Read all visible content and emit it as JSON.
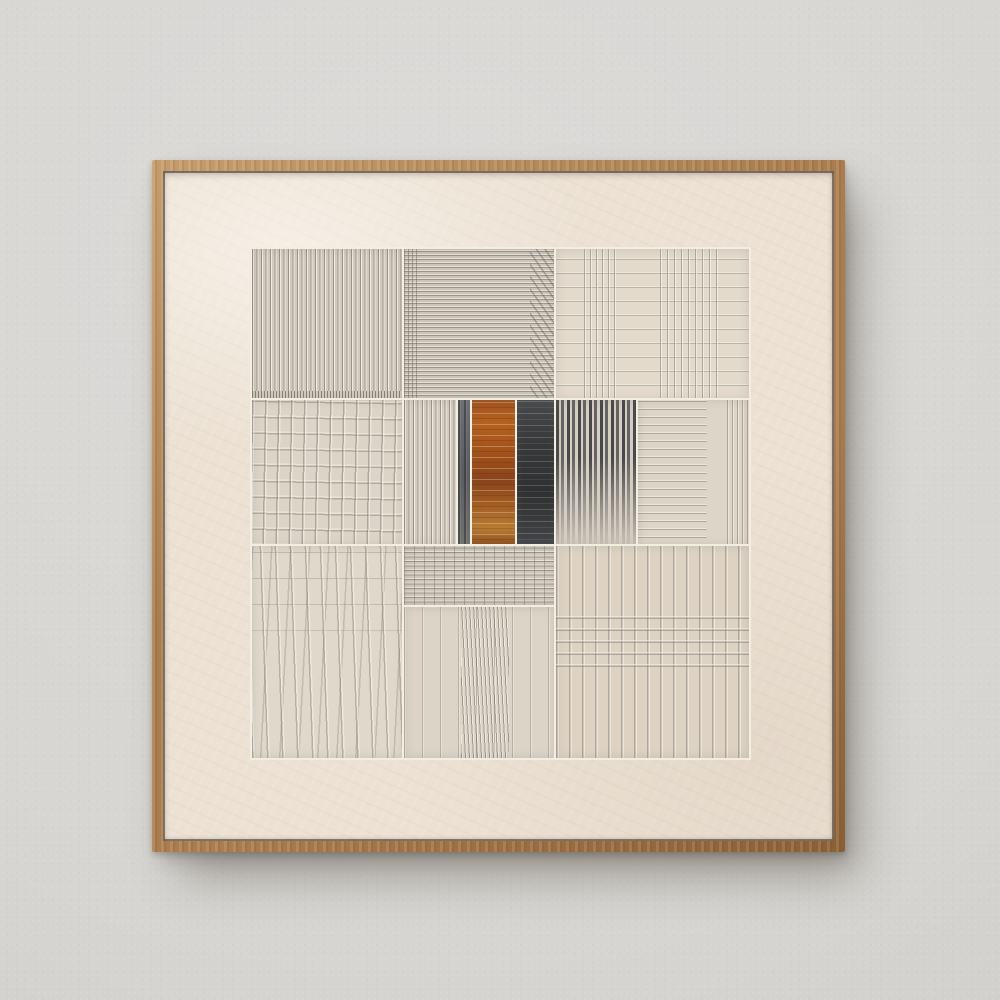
{
  "scene": {
    "description": "Square abstract textured-plaster artwork in a thin natural oak floater frame, hanging centered on a light gray stucco wall with a soft shadow cast to the lower right",
    "text_content": "none (no visible text in image)"
  },
  "palette": {
    "wall_top": "#dcdbd9",
    "wall_mid": "#d7d5d1",
    "wall_bottom": "#c9c7c3",
    "wood_light": "#c59d6d",
    "wood": "#aa7c4e",
    "wood_dark": "#8a5f35",
    "canvas": "#ece1d3",
    "grout": "#f3eee2",
    "ridge_shadow": "#6c6860",
    "ridge_highlight": "#fbf7ef",
    "accent_orange": "#a85722",
    "accent_orange_light": "#b87c33",
    "accent_charcoal": "#35373a",
    "stripe_dark": "#4a4c50"
  },
  "frame": {
    "x": 152,
    "y": 160,
    "w": 693,
    "h": 692,
    "wood": 11
  },
  "artwork": {
    "x": 252,
    "y": 249,
    "w": 497,
    "h": 509,
    "style": "patchwork grid of combed plaster squares, rust and charcoal accent bands at center",
    "panels": [
      {
        "id": "top-left",
        "x": 0,
        "y": 0,
        "w": 152,
        "h": 151,
        "texture": "v-dense-ticked",
        "base": "#d2cabd"
      },
      {
        "id": "top-center",
        "x": 152,
        "y": 0,
        "w": 152,
        "h": 151,
        "texture": "h-dense",
        "base": "#ccc4b6"
      },
      {
        "id": "top-right",
        "x": 304,
        "y": 0,
        "w": 193,
        "h": 151,
        "texture": "plaid-light",
        "base": "#e3dacc"
      },
      {
        "id": "mid-left",
        "x": 0,
        "y": 151,
        "w": 152,
        "h": 146,
        "texture": "plaid-open",
        "base": "#dcd4c6"
      },
      {
        "id": "mid-center-left",
        "x": 152,
        "y": 151,
        "w": 54,
        "h": 146,
        "texture": "v-dense",
        "base": "#d4cdc0"
      },
      {
        "id": "mid-dark-strip",
        "x": 206,
        "y": 151,
        "w": 14,
        "h": 146,
        "texture": "charcoal-soft",
        "base": "#686b6e"
      },
      {
        "id": "accent-orange",
        "x": 220,
        "y": 151,
        "w": 45,
        "h": 146,
        "texture": "orange",
        "base": "#a85722"
      },
      {
        "id": "accent-charcoal",
        "x": 265,
        "y": 151,
        "w": 39,
        "h": 146,
        "texture": "charcoal",
        "base": "#3b3d40"
      },
      {
        "id": "mid-stripes-dark",
        "x": 304,
        "y": 151,
        "w": 82,
        "h": 146,
        "texture": "stripes-dark",
        "base": "#d6cec1"
      },
      {
        "id": "mid-right",
        "x": 386,
        "y": 151,
        "w": 111,
        "h": 146,
        "texture": "h-sparse",
        "base": "#ddd5c7"
      },
      {
        "id": "bottom-left",
        "x": 0,
        "y": 297,
        "w": 152,
        "h": 212,
        "texture": "v-wavy",
        "base": "#e0d8ca"
      },
      {
        "id": "bottom-center-top",
        "x": 152,
        "y": 297,
        "w": 152,
        "h": 61,
        "texture": "grid-dense",
        "base": "#cfc7b9"
      },
      {
        "id": "bottom-center",
        "x": 152,
        "y": 358,
        "w": 152,
        "h": 151,
        "texture": "v-bundle",
        "base": "#dcd4c6"
      },
      {
        "id": "bottom-right",
        "x": 304,
        "y": 297,
        "w": 193,
        "h": 212,
        "texture": "plaid-vmid",
        "base": "#ded2c3"
      }
    ]
  }
}
